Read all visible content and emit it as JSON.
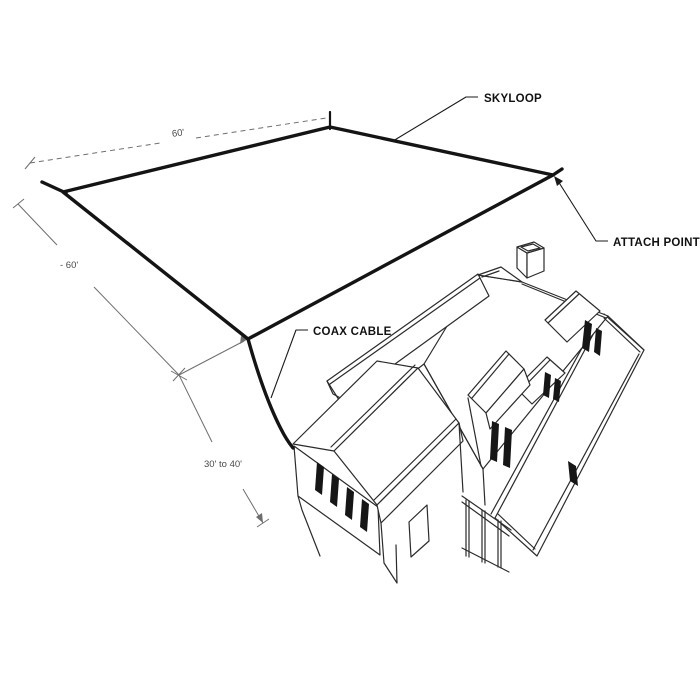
{
  "figure": {
    "callouts": {
      "skyloop": "SKYLOOP",
      "attach_point": "ATTACH POINT",
      "coax_cable": "COAX CABLE"
    },
    "dimensions": {
      "top_side": "60'",
      "left_side": "- 60'",
      "height": "30' to 40'"
    },
    "colors": {
      "background": "#ffffff",
      "antenna_wire": "#141414",
      "house_line": "#2b2b2b",
      "dimension_line": "#6e6e6e",
      "callout_text": "#111111",
      "dimension_text": "#4a4a4a"
    }
  }
}
